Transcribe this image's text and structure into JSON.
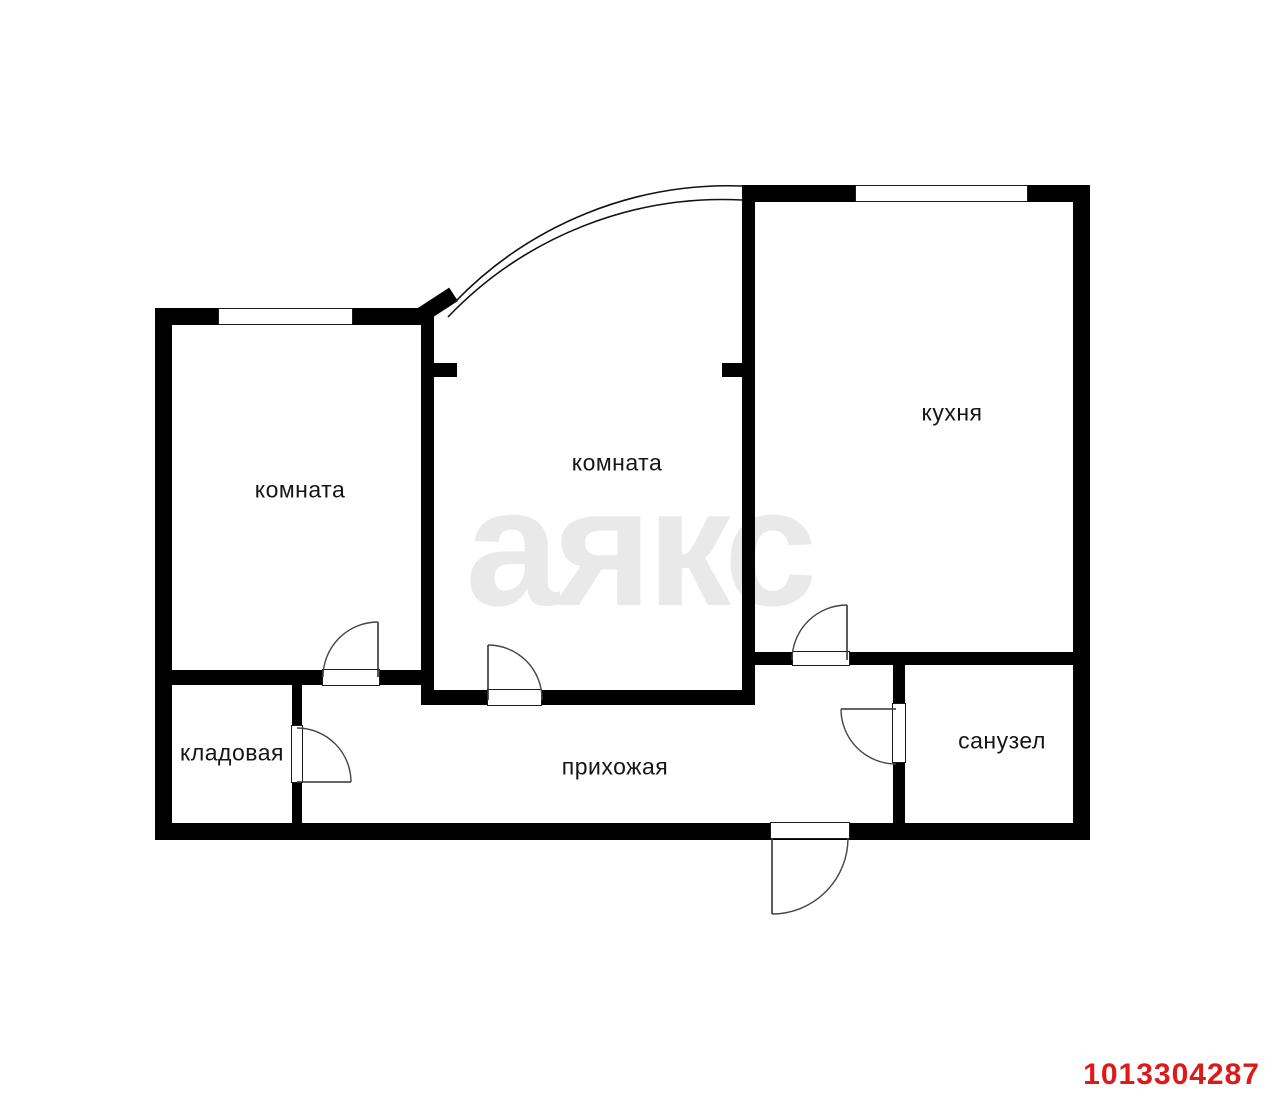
{
  "rooms": [
    {
      "id": "room-left",
      "label": "комната"
    },
    {
      "id": "room-middle",
      "label": "комната"
    },
    {
      "id": "kitchen",
      "label": "кухня"
    },
    {
      "id": "storage",
      "label": "кладовая"
    },
    {
      "id": "hallway",
      "label": "прихожая"
    },
    {
      "id": "bathroom",
      "label": "санузел"
    }
  ],
  "watermark_text": "аякс",
  "listing_id": "1013304287",
  "colors": {
    "walls": "#000000",
    "background": "#ffffff",
    "watermark": "#e9e9e9",
    "listing_id_text": "#dc1a1a"
  }
}
